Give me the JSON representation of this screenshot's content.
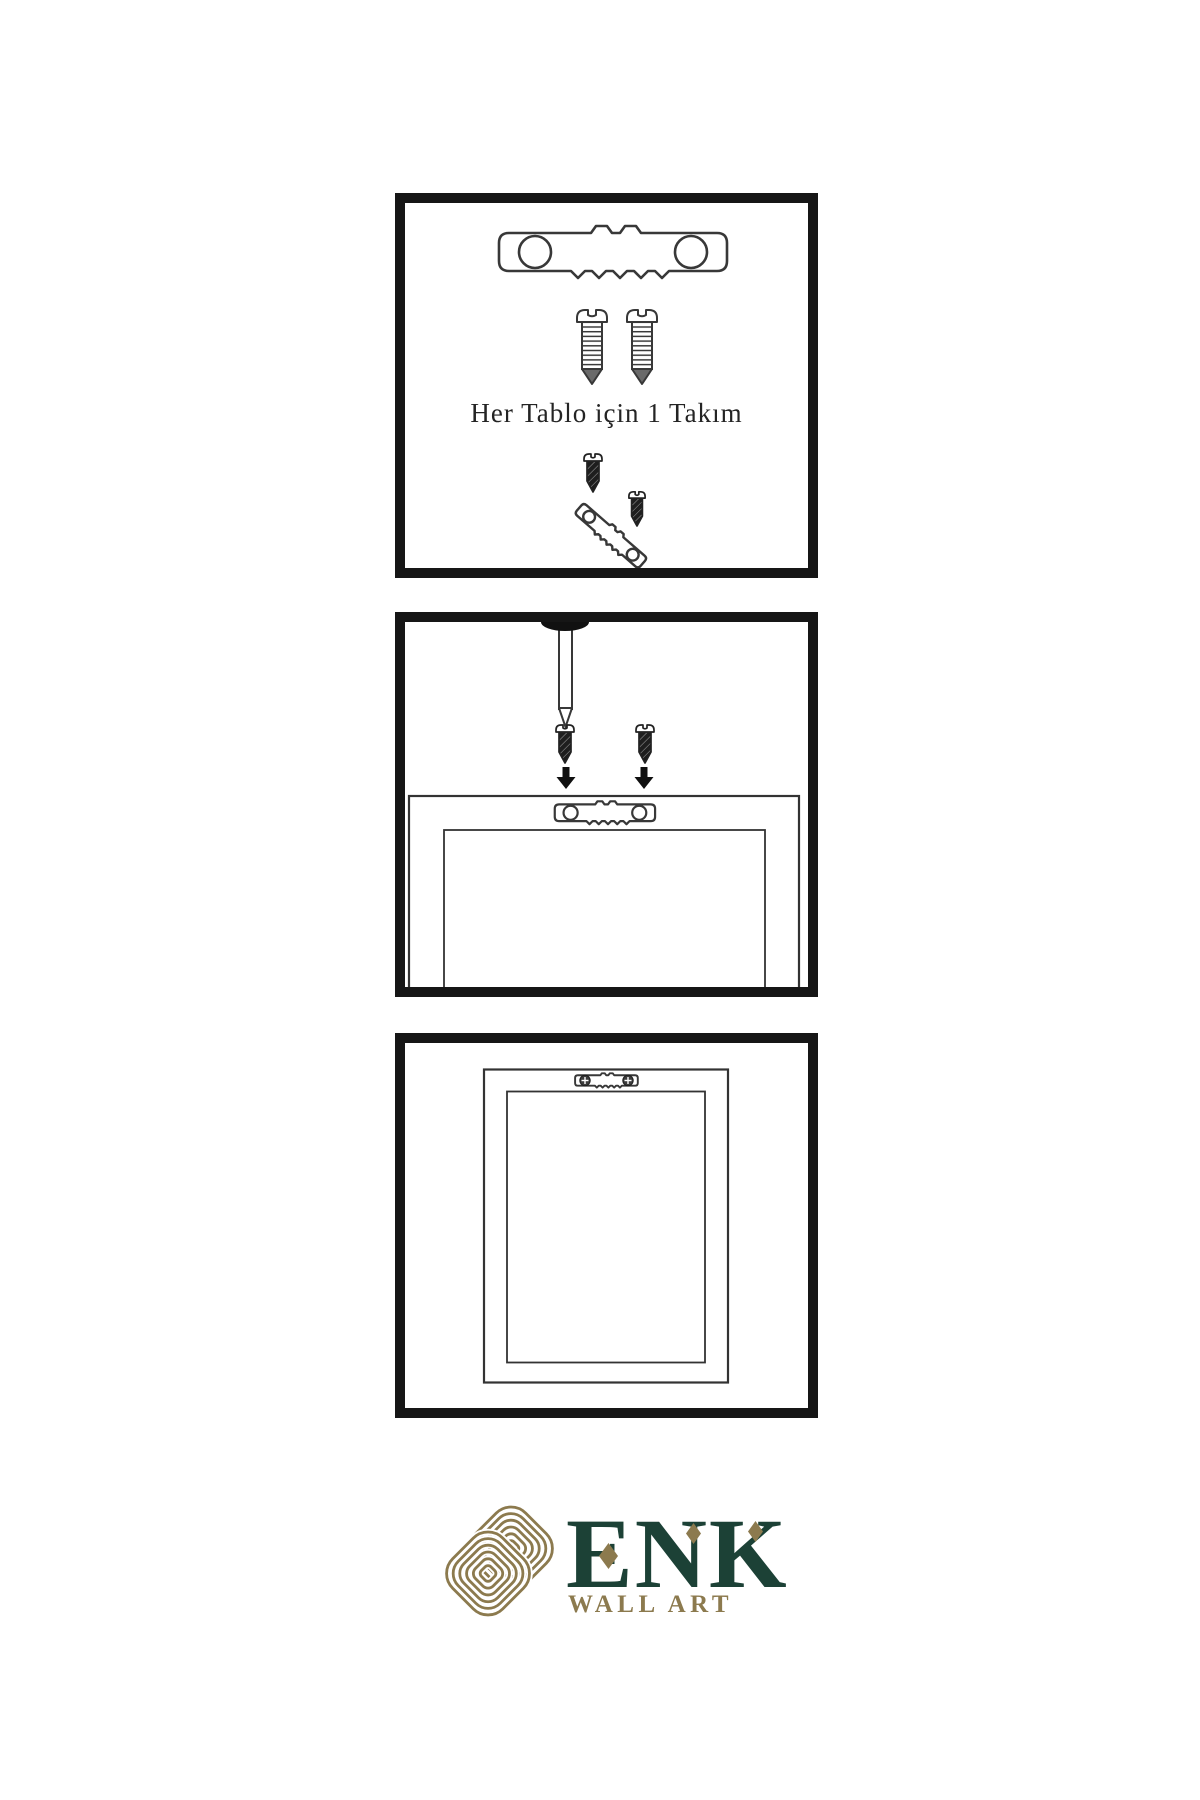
{
  "sheet": {
    "language": "Turkish",
    "background": "#ffffff",
    "panel_border_color": "#161616",
    "outline_ink": "#383838"
  },
  "panels": [
    {
      "id": 1,
      "caption": "Her Tablo için 1 Takım",
      "shows": [
        "sawtooth-hanger",
        "mounting-screw",
        "mounting-screw",
        "screws-driven-into-tilted-hanger"
      ]
    },
    {
      "id": 2,
      "caption": "",
      "shows": [
        "wall-nail",
        "screw-with-down-arrow",
        "screw-with-down-arrow",
        "frame-back-with-sawtooth-hanger"
      ]
    },
    {
      "id": 3,
      "caption": "",
      "shows": [
        "hanging-frame-back-with-mounted-hanger"
      ]
    }
  ],
  "logo": {
    "brand": "ENK",
    "subtitle": "WALL ART",
    "symbol": "interlocked-knot",
    "green": "#1c4136",
    "gold": "#8c7a4e"
  }
}
